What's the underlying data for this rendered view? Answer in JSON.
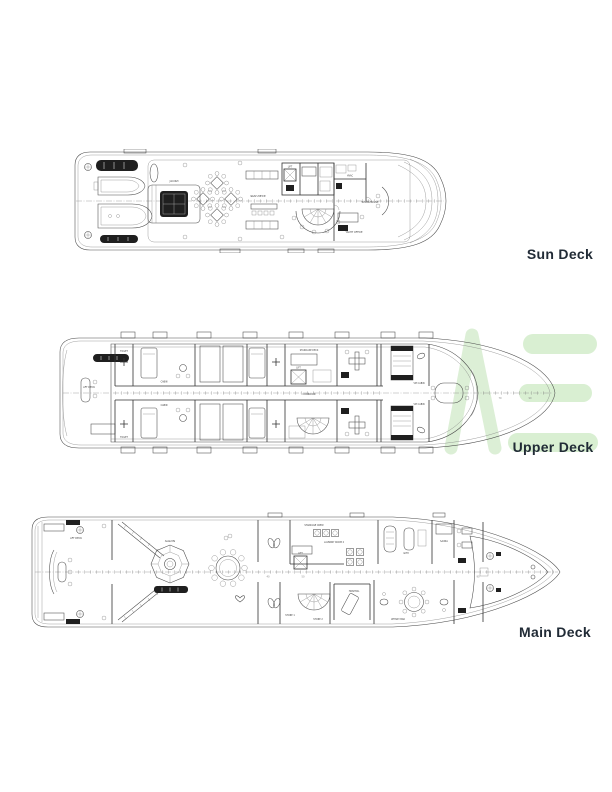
{
  "page": {
    "type": "yacht deck plans brochure page"
  },
  "decks": [
    {
      "label": "Sun Deck",
      "annotations": {
        "deck": "SUN DECK",
        "jacuzzi": "JACUZZI",
        "lift": "LIFT",
        "hvac": "HVAC",
        "wheelhouse": "WHEELHOUSE",
        "office": "YACHT OFFICE"
      }
    },
    {
      "label": "Upper Deck",
      "annotations": {
        "aft": "AFT DECK",
        "toilet1": "TOILET",
        "toilet2": "TOILET",
        "cabin1": "CABIN",
        "cabin2": "CABIN",
        "stairs": "STAIRCASE DECK",
        "lift": "LIFT",
        "corridor": "CORRIDOR",
        "vip1": "VIP CABIN",
        "vip2": "VIP CABIN"
      },
      "stations": [
        "70",
        "90"
      ]
    },
    {
      "label": "Main Deck",
      "annotations": {
        "aft": "AFT DECK",
        "salon": "SALON",
        "stairs": "STAIRCASE CREW",
        "lift": "LIFT",
        "laundry": "LAUNDRY ROOM 2",
        "store1": "STORE 1",
        "store2": "STORE 2",
        "hospital": "HOSPITAL",
        "gym": "GYM",
        "sauna": "SAUNA",
        "bar": "WHISKY BAR"
      },
      "stations": [
        "40",
        "50",
        "90"
      ]
    }
  ],
  "watermark": {
    "name": "ME monogram",
    "color": "#d9efd2"
  },
  "colors": {
    "ink": "#4a4a4a",
    "dark_fill": "#1f1f1f",
    "label_text": "#212b36"
  }
}
